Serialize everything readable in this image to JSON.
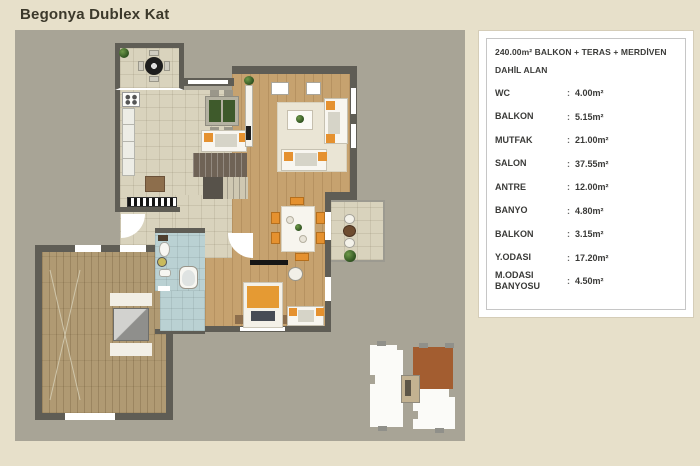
{
  "page": {
    "title": "Begonya Dublex Kat"
  },
  "legend": {
    "title": "240.00m² BALKON + TERAS + MERDİVEN DAHİL ALAN",
    "separator": ":",
    "rows": [
      {
        "label": "WC",
        "value": "4.00m²"
      },
      {
        "label": "BALKON",
        "value": "5.15m²"
      },
      {
        "label": "MUTFAK",
        "value": "21.00m²"
      },
      {
        "label": "SALON",
        "value": "37.55m²"
      },
      {
        "label": "ANTRE",
        "value": "12.00m²"
      },
      {
        "label": "BANYO",
        "value": "4.80m²"
      },
      {
        "label": "BALKON",
        "value": "3.15m²"
      },
      {
        "label": "Y.ODASI",
        "value": "17.20m²"
      },
      {
        "label": "M.ODASI BANYOSU",
        "value": "4.50m²"
      }
    ]
  },
  "floor_plan": {
    "type": "architectural-top-view",
    "colors": {
      "page_bg": "#e7e0ca",
      "plan_bg": "#a8a496",
      "wall": "#5f5d55",
      "tile_floor": "#d9d3bd",
      "wood_floor": "#c6a26f",
      "terrace_floor": "#b09a73",
      "bathroom_tile": "#bad1d3",
      "accent_orange": "#e5912f",
      "keyplan_unit_highlight": "#a35d30",
      "title_text": "#3c392b"
    }
  }
}
